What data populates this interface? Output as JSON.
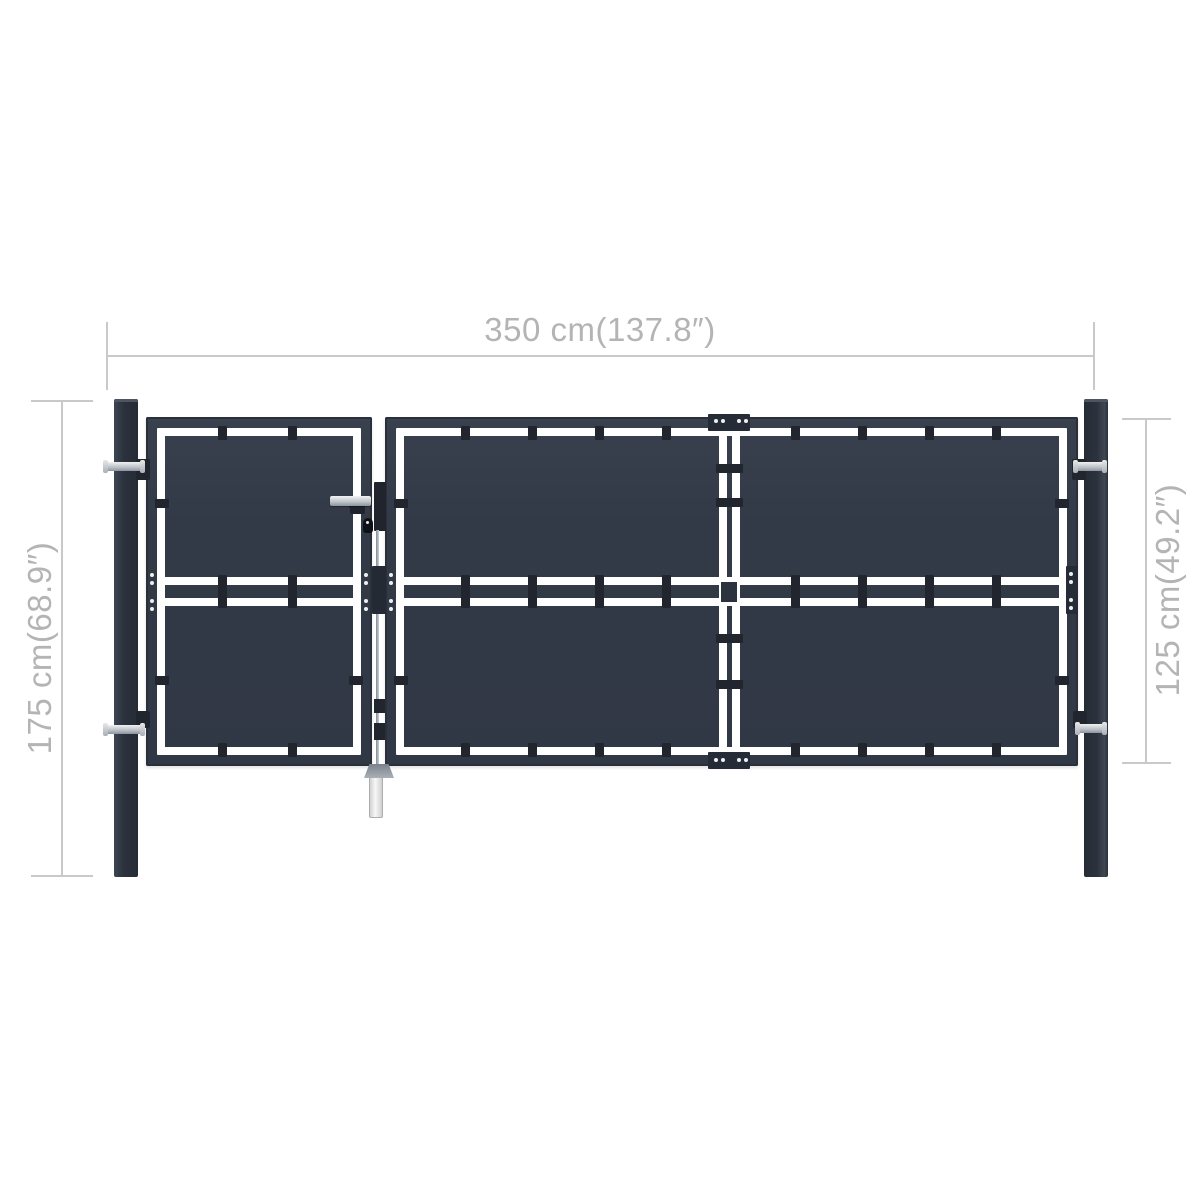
{
  "annotations": {
    "width_label": "350 cm(137.8″)",
    "post_height_label": "175 cm(68.9″)",
    "gate_height_label": "125 cm(49.2″)"
  },
  "colors": {
    "background": "#ffffff",
    "gate_panel": "#343b48",
    "gate_frame_dark": "#20252e",
    "hardware_plate": "#262c37",
    "post": "#2c323d",
    "panel_gap_white": "#ffffff",
    "dimension_line": "#c9c9c9",
    "dimension_text": "#b4b4b4",
    "hardware_silver": "#c0c6cd"
  }
}
